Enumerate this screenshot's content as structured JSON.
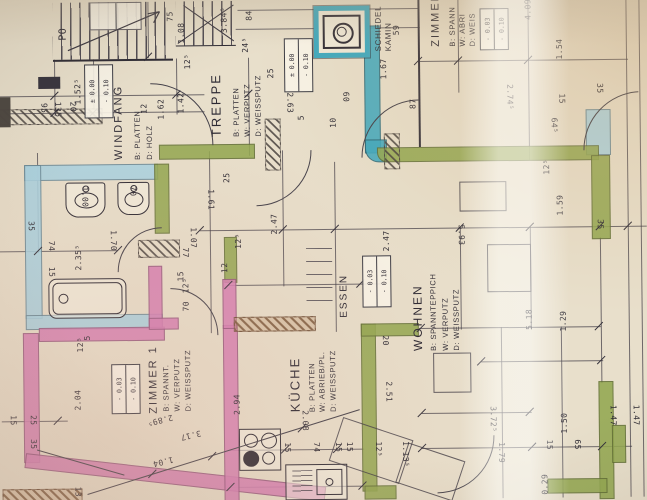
{
  "palette": {
    "paper": "#e8dfcb",
    "ink": "#2e2b34",
    "wall_cyan": "#a9d3e2",
    "wall_teal": "#3fa9bf",
    "wall_green": "#93a851",
    "wall_pink": "#d77fb4"
  },
  "stairs_label": "PO",
  "rooms": {
    "windfang": {
      "name": "WINDFANG",
      "l1": "B: PLATTEN",
      "l2": "D: HOLZ",
      "level": [
        "± 0.00",
        "- 0.10"
      ]
    },
    "treppe": {
      "name": "TREPPE",
      "l1": "B: PLATTEN",
      "l2": "W: VERPUTZ",
      "l3": "D: WEISSPUTZ",
      "level": [
        "± 0.00",
        "- 0.10"
      ]
    },
    "kamin": {
      "name1": "SCHIEDEL",
      "name2": "KAMIN"
    },
    "zimmer2": {
      "name": "ZIMMER",
      "l1": "B: SPANN",
      "l2": "W: ABRI",
      "l3": "D: WEIS",
      "level": [
        "- 0.03",
        "- 0.10"
      ]
    },
    "essen": {
      "name": "ESSEN",
      "level": [
        "- 0.03",
        "- 0.10"
      ]
    },
    "wohnen": {
      "name": "WOHNEN",
      "l1": "B: SPANNTEPPICH",
      "l2": "W: VERPUTZ",
      "l3": "D: WEISSPUTZ"
    },
    "zimmer1": {
      "name": "ZIMMER 1",
      "l1": "B: SPANNT.",
      "l2": "W: VERPUTZ",
      "l3": "D: WEISSPUTZ",
      "level": [
        "- 0.03",
        "- 0.10"
      ]
    },
    "kueche": {
      "name": "KÜCHE",
      "l1": "B: PLATTEN",
      "l2": "W: ABRIEB/PL.",
      "l3": "D: WEISSPUTZ"
    }
  },
  "fixtures": {
    "sink_left": "1.00",
    "sink_right": "70"
  },
  "dims": [
    "75",
    "1.08",
    "84",
    "3.84⁵",
    "24⁵",
    "59",
    "1.67",
    "87",
    "4.09",
    "1.54",
    "2.74⁵",
    "35",
    "15",
    "64⁵",
    "12⁵",
    "1.59",
    "35",
    "1.52⁵",
    "95",
    "135",
    "20",
    "1.62",
    "12",
    "1.42",
    "12⁵",
    "2.63",
    "60",
    "25",
    "1.61",
    "1.70",
    "1.07",
    "12⁵",
    "2.47",
    "2.47",
    "2.35⁵",
    "74",
    "35",
    "15",
    "70",
    "12⁵",
    "77",
    "15",
    "5.93",
    "5.18",
    "1.29",
    "2.04",
    "12⁵",
    "2.89⁵",
    "3.17",
    "1.04",
    "13",
    "15",
    "25",
    "35",
    "2.94",
    "2.08",
    "15",
    "74",
    "15",
    "15",
    "2.51",
    "20",
    "1.13⁵",
    "12⁵",
    "3.72⁵",
    "1.79",
    "1.50",
    "15",
    "65",
    "0.29",
    "1.47",
    "1.47",
    "25",
    "10",
    "12",
    "5",
    "5"
  ]
}
